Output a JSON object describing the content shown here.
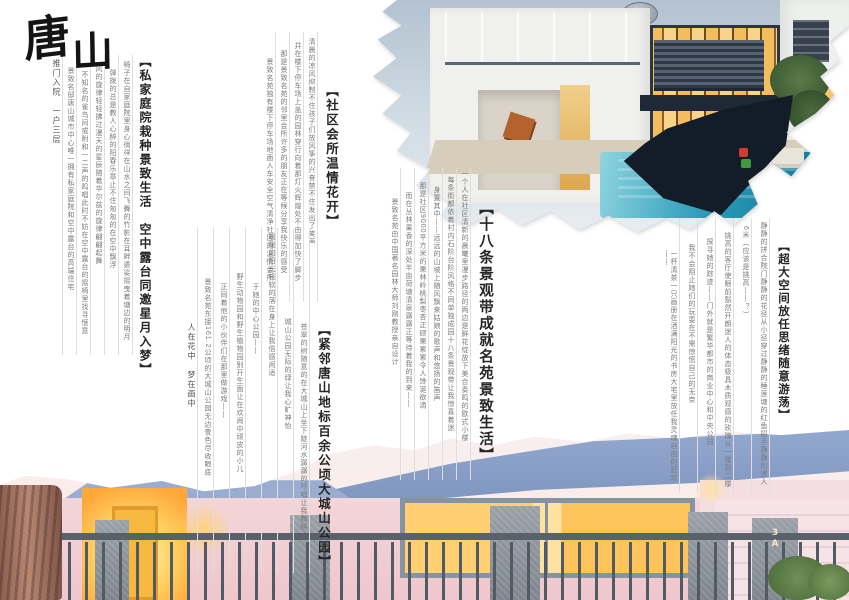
{
  "brand": {
    "name": "唐山",
    "char1": "唐",
    "char2": "山"
  },
  "sections": [
    {
      "id": "private-courtyard",
      "title": "【私家庭院栽种景致生活　空中露台同邀星月入梦】",
      "columns": [
        "椅子在自家庭院里身心徜徉在山水之间飞舞的竹影在耳畔婆娑摇曳着塘边的明月",
        "弹拨的总是教人心醉的阳春乐章止不住匆匆的在空中飘浮",
        "风的旋律轻轻拂过漫天的星辰随着华尔兹的旋律翩翩起舞",
        "不知名的雀鸟间或附和一二声的鸣唱此时不妨在空中露台的摇椅里找寻惬意",
        "景致名邸唐山城市中心唯一拥有私家庭院和空中露台的高端住宅"
      ],
      "tagline": "推门入院　一户三层"
    },
    {
      "id": "community-club",
      "title": "【社区会所温情花开】",
      "columns": [
        "清晨的凉风抑制不住孩子们放风筝的兴奋禁不住发出了笑声",
        "并在楼下停车场上盖的园林穿行向着那灯火辉煌处不由得加快了脚步",
        "那是景致名苑的邻里会所许多的朋友正在等候分享我快乐的感受",
        "景致名苑独有楼下停车场地面人车安全空气清净社区的温情会所"
      ]
    },
    {
      "id": "eighteen-belts",
      "title": "【十八条景观带成就名苑景致生活】",
      "columns": [
        "一个人在社区清新的晨曦里漫步路径的两边是鲜花绽放下美合奏鸣的欧式小楼",
        "每条街都依着村内石阶台阶风格不同单独成园十八条景观带让我惊喜着迷",
        "身置其中——远远的山坡上随风飘来姑娘的歌声和悠扬的笛声",
        "那是社区9000平方米的果林岭桃梨枣杏正硕果累累令人馋涎欲滴",
        "而在丛林果香的深处半亩荷塘清泉潺潺正等待着我的到来——",
        "景致名苑由中国著名园林大师刘刚教授亲自设计"
      ]
    },
    {
      "id": "supersize-space",
      "title": "【超大空间放任思绪随意游荡】",
      "columns": [
        "静静的拼合院门静静的花径从小径穿过静静的睡莲塘的红鱼招手静静的迷人",
        "6米（应该是挑高——？）",
        "挑高的客厅使眼前豁然开朗迷人的体态极具木质观感的玫瑰从一楼到二楼",
        "探寻她的踪迹——门外就是繁华都市的商业中心和中央公园",
        "我不会阻止她们的玩耍在不需惊慌自己的无奈",
        "一杯清茶一只画册在洒满阳光的书房大宅里放任我灵魂自由的狂欢——"
      ]
    },
    {
      "id": "dachengshan-park",
      "title": "【紧邻唐山地标百余公顷大城山公园】",
      "columns": [
        "苍翠的树随意的在大城山上坐下陡河水潺潺的哼唱让我陶醉",
        "城山公园无际的绿让我心旷神怡",
        "暖暖的阳光轻软的落在身上让我倍感闲适",
        "于她的中心公园——",
        "野生动物园和野生植物园别开生面让在欢闹中顽皮的小儿",
        "正同着他的小伙伴们在那里做游戏——",
        "景致名苑东接161.2公顷的大城山公园无边景色尽收眼底"
      ],
      "tagline": "人在花中　梦在画中"
    }
  ],
  "photos": {
    "bottom": {
      "house_number_line1": "3",
      "house_number_line2": "A"
    }
  },
  "colors": {
    "pool_teal": "#2b9cba",
    "window_glow": "#ffc35e",
    "roof_blue": "#8ca2c9",
    "heading_ink": "#262626",
    "body_gray": "#7b7b7b",
    "rule_gray": "#dedede",
    "torn_dark": "#131c29"
  }
}
